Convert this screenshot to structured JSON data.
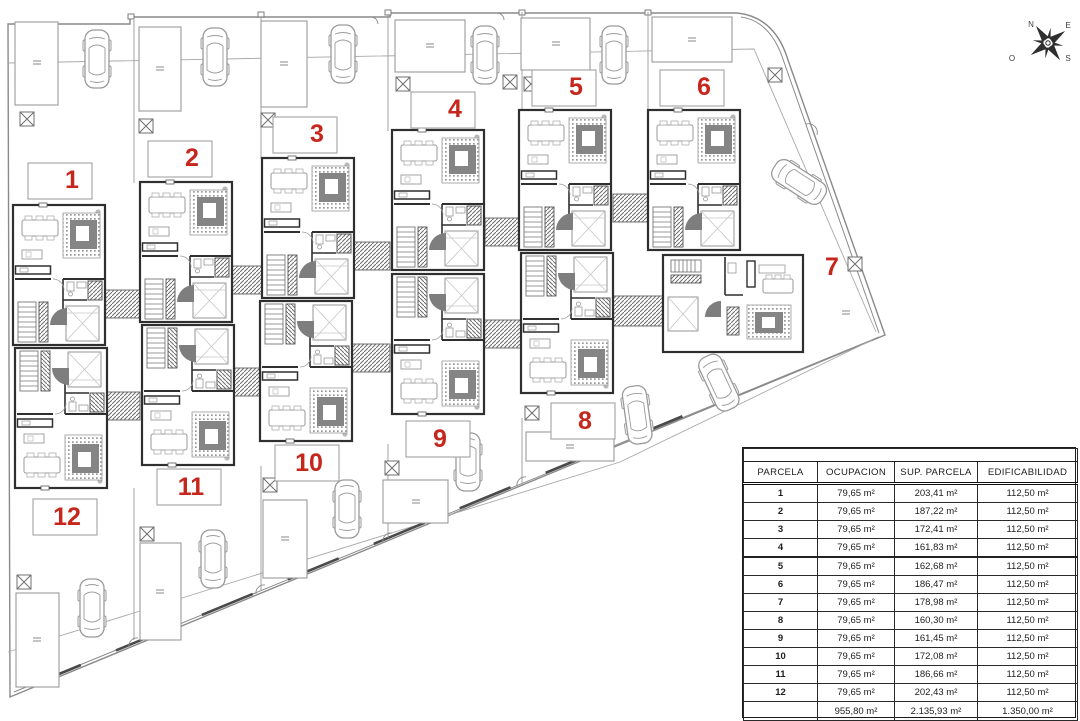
{
  "plan": {
    "parcel_number_color": "#c5271d",
    "parcels": [
      {
        "number": "1"
      },
      {
        "number": "2"
      },
      {
        "number": "3"
      },
      {
        "number": "4"
      },
      {
        "number": "5"
      },
      {
        "number": "6"
      },
      {
        "number": "7"
      },
      {
        "number": "8"
      },
      {
        "number": "9"
      },
      {
        "number": "10"
      },
      {
        "number": "11"
      },
      {
        "number": "12"
      }
    ],
    "compass": {
      "n": "N",
      "e": "E",
      "s": "S",
      "o": "O"
    }
  },
  "table": {
    "headers": [
      "PARCELA",
      "OCUPACION",
      "SUP. PARCELA",
      "EDIFICABILIDAD"
    ],
    "rows": [
      {
        "parcela": "1",
        "ocupacion": "79,65 m²",
        "sup": "203,41 m²",
        "edif": "112,50 m²"
      },
      {
        "parcela": "2",
        "ocupacion": "79,65 m²",
        "sup": "187,22 m²",
        "edif": "112,50 m²"
      },
      {
        "parcela": "3",
        "ocupacion": "79,65 m²",
        "sup": "172,41 m²",
        "edif": "112,50 m²"
      },
      {
        "parcela": "4",
        "ocupacion": "79,65 m²",
        "sup": "161,83 m²",
        "edif": "112,50 m²"
      },
      {
        "parcela": "5",
        "ocupacion": "79,65 m²",
        "sup": "162,68 m²",
        "edif": "112,50 m²"
      },
      {
        "parcela": "6",
        "ocupacion": "79,65 m²",
        "sup": "186,47 m²",
        "edif": "112,50 m²"
      },
      {
        "parcela": "7",
        "ocupacion": "79,65 m²",
        "sup": "178,98 m²",
        "edif": "112,50 m²"
      },
      {
        "parcela": "8",
        "ocupacion": "79,65 m²",
        "sup": "160,30 m²",
        "edif": "112,50 m²"
      },
      {
        "parcela": "9",
        "ocupacion": "79,65 m²",
        "sup": "161,45 m²",
        "edif": "112,50 m²"
      },
      {
        "parcela": "10",
        "ocupacion": "79,65 m²",
        "sup": "172,08 m²",
        "edif": "112,50 m²"
      },
      {
        "parcela": "11",
        "ocupacion": "79,65 m²",
        "sup": "186,66 m²",
        "edif": "112,50 m²"
      },
      {
        "parcela": "12",
        "ocupacion": "79,65 m²",
        "sup": "202,43 m²",
        "edif": "112,50 m²"
      }
    ],
    "total": {
      "parcela": "",
      "ocupacion": "955,80 m²",
      "sup": "2.135,93 m²",
      "edif": "1.350,00 m²"
    }
  }
}
